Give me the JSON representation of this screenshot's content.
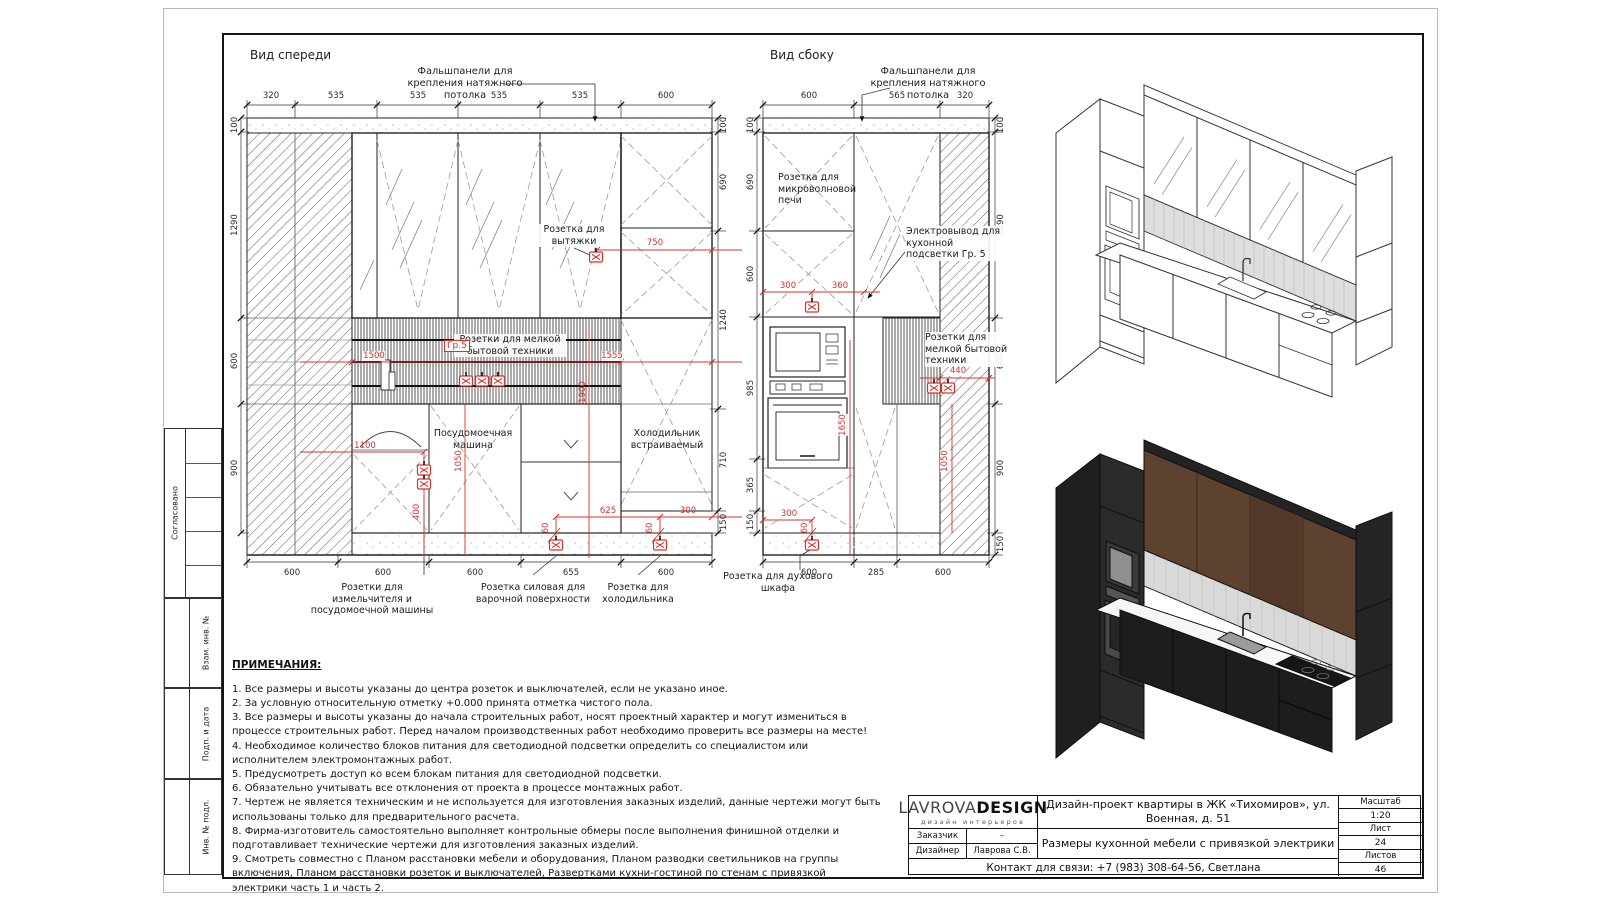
{
  "shared": {
    "false_panel_note": "Фальшпанели для крепления натяжного потолка",
    "small_appliance_sockets": "Розетки для мелкой бытовой техники"
  },
  "margin_strip": {
    "agreed": "Согласовано",
    "replace_inv": "Взам. инв. №",
    "sign_date": "Подп. и дата",
    "inv_orig": "Инв. № подл."
  },
  "front_view": {
    "title": "Вид спереди",
    "dims_top": [
      "320",
      "535",
      "535",
      "535",
      "535",
      "600"
    ],
    "dims_left": [
      "100",
      "1290",
      "600",
      "900"
    ],
    "dims_right": [
      "100",
      "690",
      "1240",
      "710",
      "150"
    ],
    "dims_bottom": [
      "600",
      "600",
      "600",
      "655",
      "600"
    ],
    "labels": {
      "hood_socket": "Розетка для вытяжки",
      "dishwasher": "Посудомоечная машина",
      "fridge": "Холодильник встраиваемый",
      "grinder_sockets": "Розетки для измельчителя и посудомоечной машины",
      "hob_socket": "Розетка силовая для варочной поверхности",
      "fridge_socket": "Розетка для холодильника",
      "group": "Гр.5"
    },
    "red_dims": {
      "hood": "750",
      "left": "1500",
      "right": "1555",
      "height": "1900",
      "sink": "1100",
      "dw": "1050",
      "low": "400",
      "r625": "625",
      "r300": "300",
      "r60a": "60",
      "r60b": "60"
    }
  },
  "side_view": {
    "title": "Вид сбоку",
    "dims_top": [
      "600",
      "565",
      "320"
    ],
    "dims_left": [
      "100",
      "690",
      "600",
      "985",
      "365",
      "150"
    ],
    "dims_right": [
      "100",
      "1290",
      "600",
      "900",
      "150"
    ],
    "dims_bottom": [
      "600",
      "285",
      "600"
    ],
    "labels": {
      "microwave_socket": "Розетка для микроволновой печи",
      "led_output": "Электровывод для кухонной подсветки Гр. 5",
      "oven_socket": "Розетка для духового шкафа"
    },
    "red_dims": {
      "a300": "300",
      "a360": "360",
      "h1650": "1650",
      "b440": "440",
      "h1050": "1050",
      "c300": "300",
      "c60": "60"
    }
  },
  "notes": {
    "title": "ПРИМЕЧАНИЯ:",
    "items": [
      "1. Все размеры и высоты указаны до центра розеток и выключателей, если не указано иное.",
      "2. За условную относительную отметку +0.000 принята отметка чистого пола.",
      "3. Все размеры и высоты указаны до начала строительных работ, носят проектный характер и могут измениться в процессе строительных работ. Перед началом производственных работ необходимо проверить все размеры на месте!",
      "4. Необходимое количество блоков питания для светодиодной подсветки определить со специалистом или исполнителем электромонтажных работ.",
      "5. Предусмотреть доступ ко всем блокам питания для светодиодной подсветки.",
      "6. Обязательно учитывать все отклонения от проекта в процессе монтажных работ.",
      "7. Чертеж не является техническим и не используется для изготовления заказных изделий, данные чертежи могут быть использованы только для предварительного расчета.",
      "8. Фирма-изготовитель самостоятельно выполняет контрольные обмеры после выполнения финишной отделки и подготавливает технические чертежи для изготовления заказных изделий.",
      "9. Смотреть совместно с Планом расстановки мебели и оборудования, Планом разводки светильников на группы включения, Планом расстановки розеток и выключателей, Развертками кухни-гостиной по стенам с привязкой электрики часть 1 и часть 2."
    ]
  },
  "title_block": {
    "logo_main": "LAVROVA",
    "logo_bold": "DESIGN",
    "logo_sub": "дизайн интерьеров",
    "customer_label": "Заказчик",
    "customer_value": "–",
    "designer_label": "Дизайнер",
    "designer_value": "Лаврова С.В.",
    "project": "Дизайн-проект квартиры в ЖК «Тихомиров», ул. Военная, д. 51",
    "sheet_title": "Размеры кухонной мебели с привязкой электрики",
    "contact": "Контакт для связи: +7 (983) 308-64-56, Светлана",
    "scale_label": "Масштаб",
    "scale_value": "1:20",
    "sheet_label": "Лист",
    "sheet_value": "24",
    "sheets_label": "Листов",
    "sheets_value": "46"
  }
}
